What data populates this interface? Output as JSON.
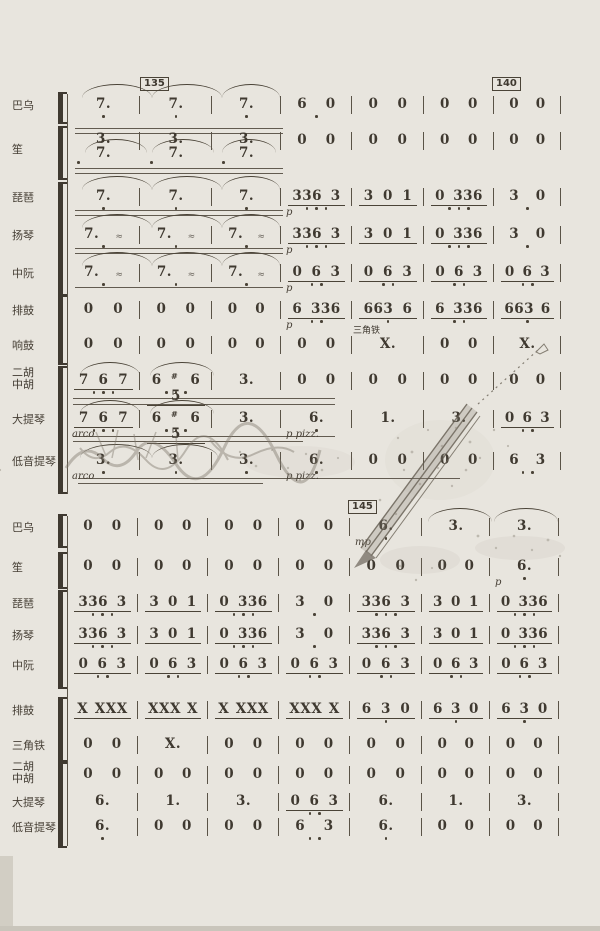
{
  "page": {
    "background": "#e8e5de",
    "ink": "#3f3930",
    "type": "numbered-notation orchestral score (jianpu)"
  },
  "markers": [
    {
      "label": "135"
    },
    {
      "label": "140"
    },
    {
      "label": "145"
    }
  ],
  "systems": [
    {
      "rows": [
        {
          "label": "巴乌",
          "cells": [
            {
              "n": "7.",
              "od": 1
            },
            {
              "n": "7.",
              "od": 1
            },
            {
              "n": "7.",
              "od": 1
            },
            {
              "n": "6 0",
              "od": 1
            },
            {
              "n": "0 0"
            },
            {
              "n": "0 0"
            },
            {
              "n": "0 0"
            }
          ]
        },
        {
          "label": "笙",
          "cells": [
            {
              "stack": [
                "3.",
                "7."
              ],
              "od": 1
            },
            {
              "stack": [
                "3.",
                "7."
              ],
              "od": 1
            },
            {
              "stack": [
                "3.",
                "7."
              ],
              "od": 1
            },
            {
              "n": "0 0"
            },
            {
              "n": "0 0"
            },
            {
              "n": "0 0"
            },
            {
              "n": "0 0"
            }
          ]
        },
        {
          "label": "琵琶",
          "cells": [
            {
              "n": "7.",
              "od": 1
            },
            {
              "n": "7.",
              "od": 1
            },
            {
              "n": "7.",
              "od": 1
            },
            {
              "n": "336 3",
              "u": 1,
              "od": 3,
              "dyn": "p"
            },
            {
              "n": "3 0 1",
              "u": 1
            },
            {
              "n": "0 336",
              "u": 1,
              "od": 3
            },
            {
              "n": "3 0",
              "od": 1
            }
          ]
        },
        {
          "label": "扬琴",
          "cells": [
            {
              "n": "7.",
              "od": 1,
              "tr": 1
            },
            {
              "n": "7.",
              "od": 1,
              "tr": 1
            },
            {
              "n": "7.",
              "od": 1,
              "tr": 1
            },
            {
              "n": "336 3",
              "u": 1,
              "od": 3,
              "dyn": "p"
            },
            {
              "n": "3 0 1",
              "u": 1
            },
            {
              "n": "0 336",
              "u": 1,
              "od": 3
            },
            {
              "n": "3 0",
              "od": 1
            }
          ]
        },
        {
          "label": "中阮",
          "cells": [
            {
              "n": "7.",
              "od": 1,
              "tr": 1
            },
            {
              "n": "7.",
              "od": 1,
              "tr": 1
            },
            {
              "n": "7.",
              "od": 1,
              "tr": 1
            },
            {
              "n": "0 6 3",
              "u": 1,
              "od": 2,
              "dyn": "p"
            },
            {
              "n": "0 6 3",
              "u": 1,
              "od": 2
            },
            {
              "n": "0 6 3",
              "u": 1,
              "od": 2
            },
            {
              "n": "0 6 3",
              "u": 1,
              "od": 2
            }
          ]
        },
        {
          "label": "排鼓",
          "cells": [
            {
              "n": "0 0"
            },
            {
              "n": "0 0"
            },
            {
              "n": "0 0"
            },
            {
              "n": "6 336",
              "u": 1,
              "od": 2,
              "dyn": "p"
            },
            {
              "n": "663 6",
              "u": 1,
              "od": 1
            },
            {
              "n": "6 336",
              "u": 1,
              "od": 2
            },
            {
              "n": "663 6",
              "u": 1,
              "od": 1
            }
          ]
        },
        {
          "label": "响鼓",
          "cells": [
            {
              "n": "0 0"
            },
            {
              "n": "0 0"
            },
            {
              "n": "0 0"
            },
            {
              "n": "0 0"
            },
            {
              "n": "X.",
              "ann": "三角铁"
            },
            {
              "n": "0 0"
            },
            {
              "n": "X."
            }
          ]
        },
        {
          "label": "二胡",
          "label2": "中胡",
          "cells": [
            {
              "n": "7 6 7",
              "u": 1,
              "od": 3
            },
            {
              "n": "6 #5 6",
              "u": 1,
              "od": 3
            },
            {
              "n": "3."
            },
            {
              "n": "0 0"
            },
            {
              "n": "0 0"
            },
            {
              "n": "0 0"
            },
            {
              "n": "0 0"
            }
          ]
        },
        {
          "label": "大提琴",
          "cells": [
            {
              "n": "7 6 7",
              "u": 1,
              "od": 3,
              "dyn": "arco"
            },
            {
              "n": "6 #5 6",
              "u": 1,
              "od": 3
            },
            {
              "n": "3."
            },
            {
              "n": "6.",
              "od": 1,
              "dyn": "p pizz."
            },
            {
              "n": "1."
            },
            {
              "n": "3."
            },
            {
              "n": "0 6 3",
              "u": 1,
              "od": 2
            }
          ]
        },
        {
          "label": "低音提琴",
          "cells": [
            {
              "n": "3.",
              "od": 1,
              "dyn": "arco"
            },
            {
              "n": "3.",
              "od": 1
            },
            {
              "n": "3.",
              "od": 1
            },
            {
              "n": "6.",
              "od": 1,
              "dyn": "p pizz."
            },
            {
              "n": "0 0"
            },
            {
              "n": "0 0"
            },
            {
              "n": "6 3",
              "od": 2
            }
          ]
        }
      ]
    },
    {
      "rows": [
        {
          "label": "巴乌",
          "cells": [
            {
              "n": "0 0"
            },
            {
              "n": "0 0"
            },
            {
              "n": "0 0"
            },
            {
              "n": "0 0"
            },
            {
              "n": "6.",
              "od": 1,
              "dyn": "mp"
            },
            {
              "n": "3."
            },
            {
              "n": "3."
            }
          ]
        },
        {
          "label": "笙",
          "cells": [
            {
              "n": "0 0"
            },
            {
              "n": "0 0"
            },
            {
              "n": "0 0"
            },
            {
              "n": "0 0"
            },
            {
              "n": "0 0"
            },
            {
              "n": "0 0"
            },
            {
              "n": "6.",
              "od": 1,
              "dyn": "p"
            }
          ]
        },
        {
          "label": "琵琶",
          "cells": [
            {
              "n": "336 3",
              "u": 1,
              "od": 3
            },
            {
              "n": "3 0 1",
              "u": 1
            },
            {
              "n": "0 336",
              "u": 1,
              "od": 3
            },
            {
              "n": "3 0",
              "od": 1
            },
            {
              "n": "336 3",
              "u": 1,
              "od": 3
            },
            {
              "n": "3 0 1",
              "u": 1
            },
            {
              "n": "0 336",
              "u": 1,
              "od": 3
            }
          ]
        },
        {
          "label": "扬琴",
          "cells": [
            {
              "n": "336 3",
              "u": 1,
              "od": 3
            },
            {
              "n": "3 0 1",
              "u": 1
            },
            {
              "n": "0 336",
              "u": 1,
              "od": 3
            },
            {
              "n": "3 0",
              "od": 1
            },
            {
              "n": "336 3",
              "u": 1,
              "od": 3
            },
            {
              "n": "3 0 1",
              "u": 1
            },
            {
              "n": "0 336",
              "u": 1,
              "od": 3
            }
          ]
        },
        {
          "label": "中阮",
          "cells": [
            {
              "n": "0 6 3",
              "u": 1,
              "od": 2
            },
            {
              "n": "0 6 3",
              "u": 1,
              "od": 2
            },
            {
              "n": "0 6 3",
              "u": 1,
              "od": 2
            },
            {
              "n": "0 6 3",
              "u": 1,
              "od": 2
            },
            {
              "n": "0 6 3",
              "u": 1,
              "od": 2
            },
            {
              "n": "0 6 3",
              "u": 1,
              "od": 2
            },
            {
              "n": "0 6 3",
              "u": 1,
              "od": 2
            }
          ]
        },
        {
          "label": "排鼓",
          "cells": [
            {
              "n": "X XXX",
              "u": 1
            },
            {
              "n": "XXX X",
              "u": 1
            },
            {
              "n": "X XXX",
              "u": 1
            },
            {
              "n": "XXX X",
              "u": 1
            },
            {
              "n": "6 3 0",
              "u": 1,
              "od": 1
            },
            {
              "n": "6 3 0",
              "u": 1,
              "od": 1
            },
            {
              "n": "6 3 0",
              "u": 1,
              "od": 1
            }
          ]
        },
        {
          "label": "三角铁",
          "cells": [
            {
              "n": "0 0"
            },
            {
              "n": "X."
            },
            {
              "n": "0 0"
            },
            {
              "n": "0 0"
            },
            {
              "n": "0 0"
            },
            {
              "n": "0 0"
            },
            {
              "n": "0 0"
            }
          ]
        },
        {
          "label": "二胡",
          "label2": "中胡",
          "cells": [
            {
              "n": "0 0"
            },
            {
              "n": "0 0"
            },
            {
              "n": "0 0"
            },
            {
              "n": "0 0"
            },
            {
              "n": "0 0"
            },
            {
              "n": "0 0"
            },
            {
              "n": "0 0"
            }
          ]
        },
        {
          "label": "大提琴",
          "cells": [
            {
              "n": "6."
            },
            {
              "n": "1."
            },
            {
              "n": "3."
            },
            {
              "n": "0 6 3",
              "u": 1,
              "od": 2
            },
            {
              "n": "6."
            },
            {
              "n": "1."
            },
            {
              "n": "3."
            }
          ]
        },
        {
          "label": "低音提琴",
          "cells": [
            {
              "n": "6.",
              "od": 1
            },
            {
              "n": "0 0"
            },
            {
              "n": "0 0"
            },
            {
              "n": "6 3",
              "od": 2
            },
            {
              "n": "6.",
              "od": 1
            },
            {
              "n": "0 0"
            },
            {
              "n": "0 0"
            }
          ]
        }
      ]
    }
  ]
}
